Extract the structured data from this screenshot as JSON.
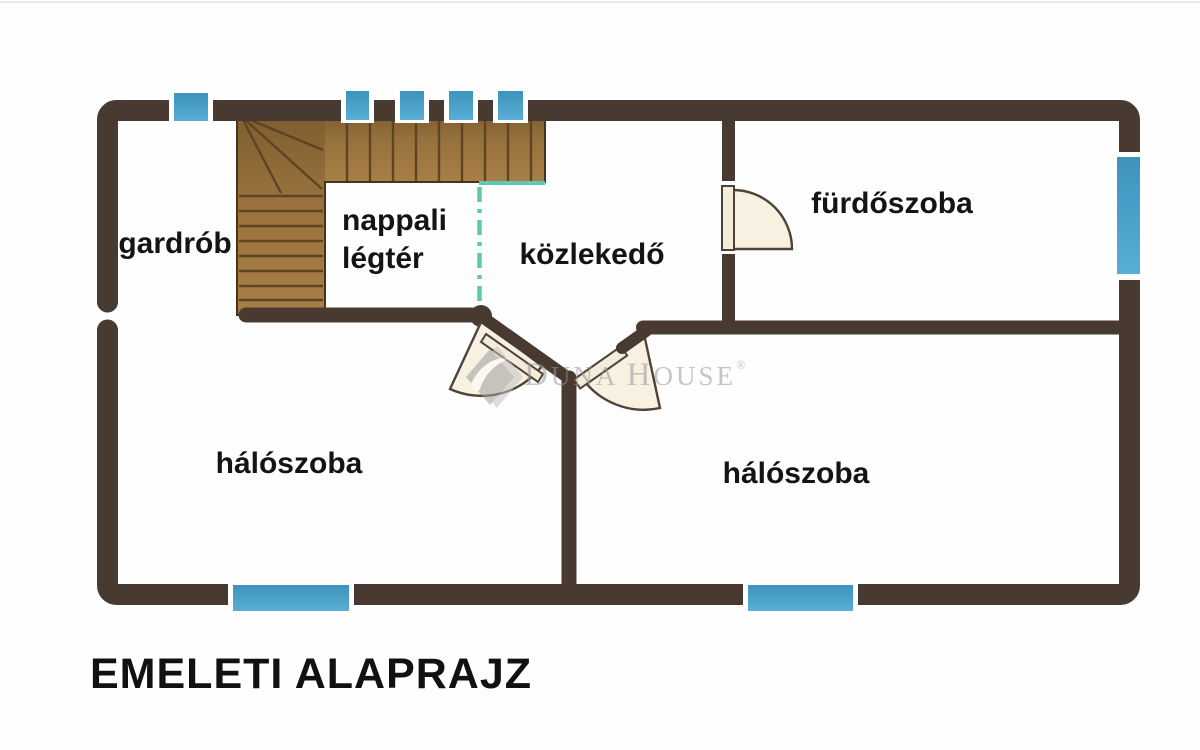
{
  "title": "EMELETI ALAPRAJZ",
  "watermark": {
    "initial_1": "D",
    "rest_1": "UNA",
    "initial_2": "H",
    "rest_2": "OUSE",
    "registered": "®",
    "logo": "duna-house-diamond-leaf"
  },
  "rooms": {
    "gardrob": {
      "label": "gardrób"
    },
    "nappali": {
      "line1": "nappali",
      "line2": "légtér"
    },
    "kozlekedo": {
      "label": "közlekedő"
    },
    "furdoszoba": {
      "label": "fürdőszoba"
    },
    "haloszoba_left": {
      "label": "hálószoba"
    },
    "haloszoba_right": {
      "label": "hálószoba"
    }
  },
  "colors": {
    "background": "#fefefe",
    "wall": "#483a30",
    "wood_light": "#a87f46",
    "wood_mid": "#97713d",
    "wood_dark": "#7d5c2f",
    "wood_line": "#5e4423",
    "wood_outline": "#46341d",
    "window_blue_top": "#3e93bd",
    "window_blue_bottom": "#58aed4",
    "window_frame": "#ffffff",
    "void_line": "#5ec7b2",
    "door_fill": "#f8f1e2",
    "door_leaf": "#f4ecdb",
    "door_stroke": "#4f4236",
    "label": "#141414",
    "title": "#111111",
    "watermark": "#979797",
    "watermark_logo": "#9e9e9e",
    "watermark_logo_light": "#c4c4c4"
  }
}
